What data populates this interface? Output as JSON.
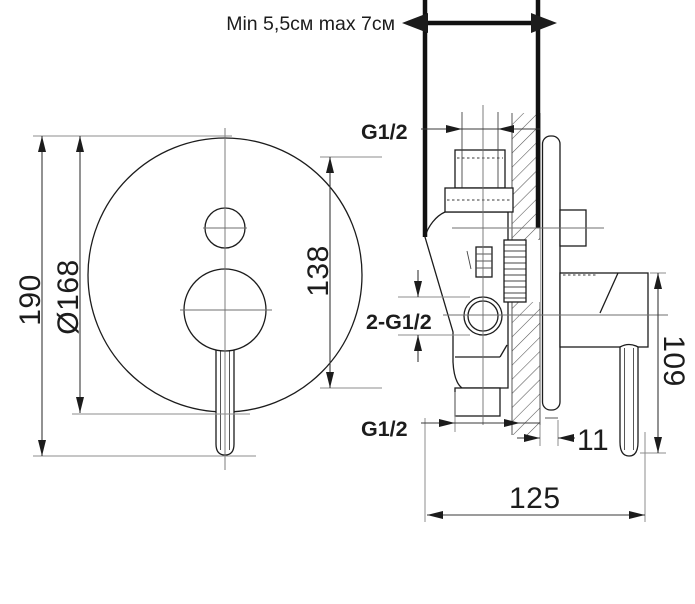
{
  "annotation": {
    "pipe_depth_note": "Min 5,5см max 7см"
  },
  "front_view": {
    "height": "190",
    "plate_diameter": "Ø168",
    "ports_distance": "138"
  },
  "side_view": {
    "top_thread": "G1/2",
    "inlet_threads": "2-G1/2",
    "bottom_thread": "G1/2",
    "plate_offset": "11",
    "handle_span": "109",
    "total_depth": "125"
  },
  "colors": {
    "line": "#1c1c1c",
    "dim": "#3a3a3a",
    "extension": "#8c8c8c",
    "background": "#ffffff"
  }
}
